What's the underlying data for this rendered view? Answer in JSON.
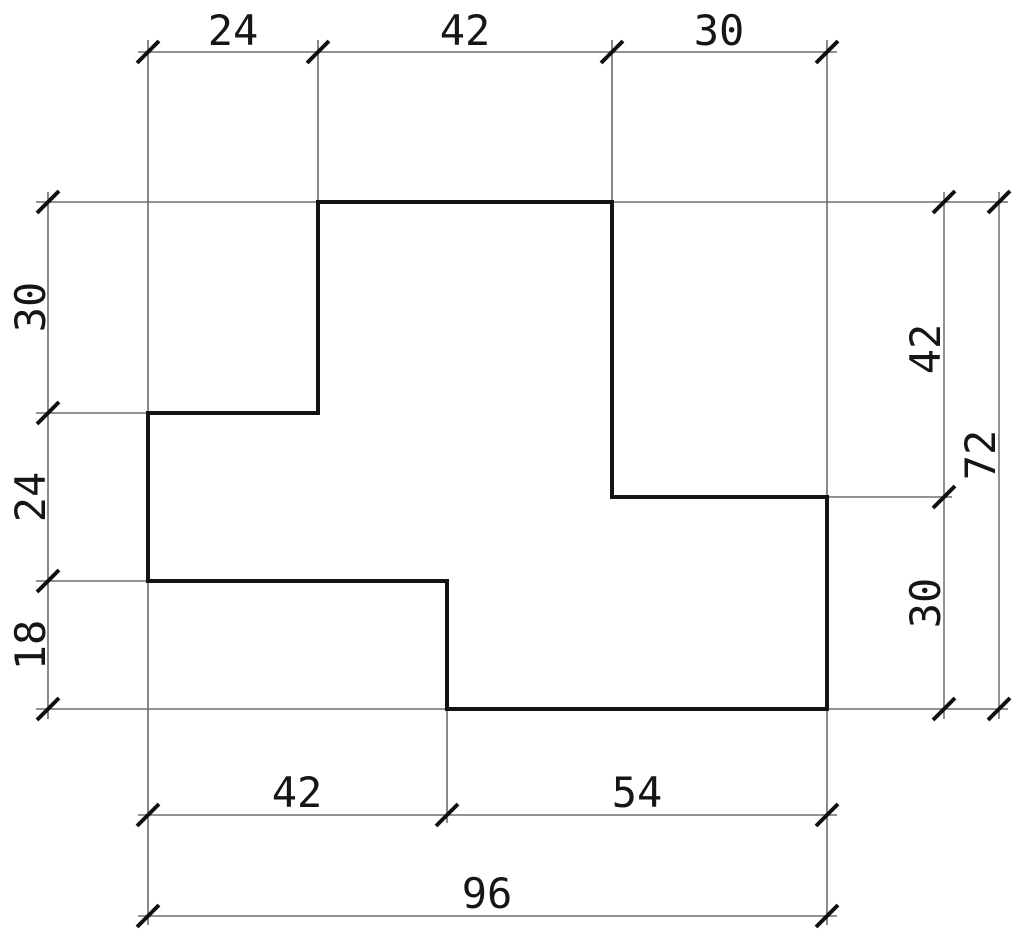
{
  "drawing": {
    "type": "technical-dimension-drawing",
    "shape": {
      "description": "stepped polygon outline",
      "vertices_units": [
        [
          24,
          0
        ],
        [
          66,
          0
        ],
        [
          66,
          42
        ],
        [
          96,
          42
        ],
        [
          96,
          72
        ],
        [
          42,
          72
        ],
        [
          42,
          54
        ],
        [
          0,
          54
        ],
        [
          0,
          30
        ],
        [
          24,
          30
        ]
      ],
      "width_units": 96,
      "height_units": 72
    },
    "dimensions": {
      "top": {
        "d1": "24",
        "d2": "42",
        "d3": "30"
      },
      "left": {
        "d1": "30",
        "d2": "24",
        "d3": "18"
      },
      "right_inner": {
        "d1": "42",
        "d2": "30"
      },
      "right_outer": {
        "d1": "72"
      },
      "bottom_inner": {
        "d1": "42",
        "d2": "54"
      },
      "bottom_outer": {
        "d1": "96"
      }
    },
    "colors": {
      "outline": "#141414",
      "dimension_lines": "#6e6e6e",
      "text": "#161616",
      "background": "#ffffff"
    }
  }
}
